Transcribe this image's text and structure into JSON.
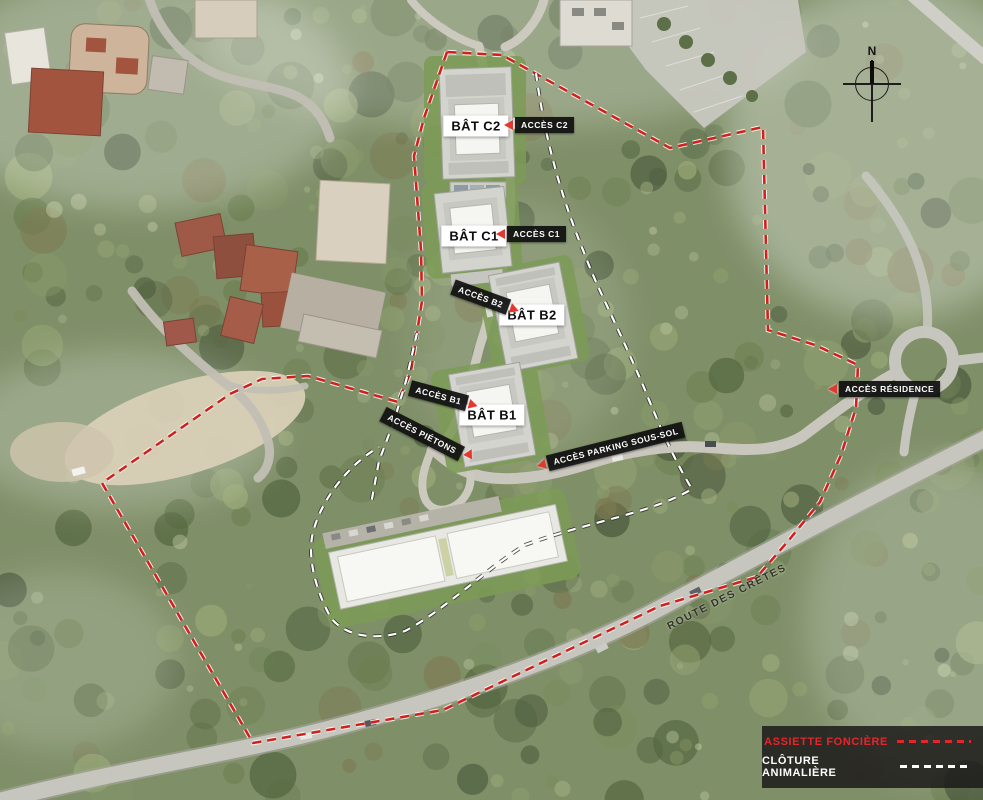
{
  "map": {
    "buildings": {
      "c2": {
        "label": "BÂT C2"
      },
      "c1": {
        "label": "BÂT C1"
      },
      "b2": {
        "label": "BÂT B2"
      },
      "b1": {
        "label": "BÂT B1"
      }
    },
    "access": {
      "c2": {
        "label": "ACCÈS C2"
      },
      "c1": {
        "label": "ACCÈS C1"
      },
      "b2": {
        "label": "ACCÈS B2"
      },
      "b1": {
        "label": "ACCÈS B1"
      },
      "pietons": {
        "label": "ACCÈS PIÉTONS"
      },
      "parking": {
        "label": "ACCÈS PARKING SOUS-SOL"
      },
      "residence": {
        "label": "ACCÈS RÉSIDENCE"
      }
    },
    "roads": {
      "route_des_cretes": {
        "label": "ROUTE DES CRÊTES"
      }
    },
    "compass": {
      "north_label": "N"
    },
    "legend": {
      "items": [
        {
          "label": "ASSIETTE FONCIÈRE",
          "color": "#e8242b",
          "style": "dashed"
        },
        {
          "label": "CLÔTURE ANIMALIÈRE",
          "color": "#ffffff",
          "style": "dashed"
        }
      ]
    },
    "colors": {
      "boundary_red": "#cf221d",
      "fence_white": "#ffffff",
      "arrow_red": "#e2382f",
      "access_label_bg": "#101010",
      "building_label_bg": "#ffffff"
    }
  }
}
